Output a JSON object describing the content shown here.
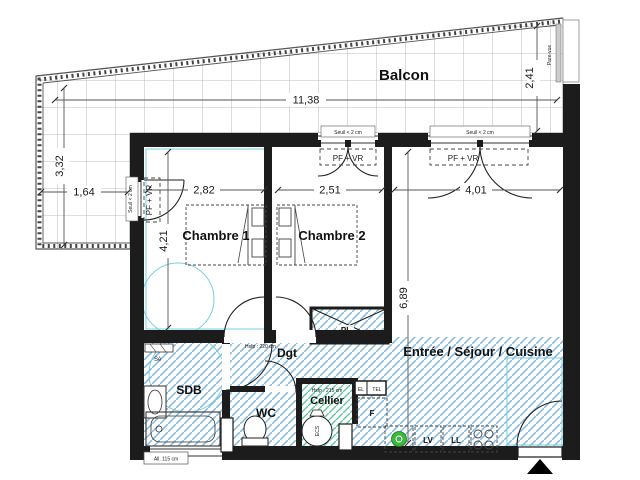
{
  "rooms": {
    "balcon": "Balcon",
    "chambre1": "Chambre 1",
    "chambre2": "Chambre 2",
    "sejour": "Entrée / Séjour / Cuisine",
    "sdb": "SDB",
    "wc": "WC",
    "dgt": "Dgt",
    "cellier": "Cellier",
    "placard": "PL"
  },
  "dimensions": {
    "balcon_length": "11,38",
    "balcon_right_depth": "2,41",
    "balcon_left_length": "3,32",
    "balcon_left_depth": "1,64",
    "chambre1_width": "2,82",
    "chambre2_width": "2,51",
    "sejour_width": "4,01",
    "chambre1_depth": "4,21",
    "sejour_depth": "6,89"
  },
  "annotations": {
    "pf_vr": "PF + VR",
    "seuil": "Seuil < 2 cm",
    "pare_vue": "Pare-vue",
    "allege": "All. 115 cm",
    "hsfp_dgt": "Hsfp : 220 cm",
    "hsfp_cellier": "Hsfp : 215 cm",
    "towel_dryer": "Sè",
    "electrical": "EL",
    "telecom": "TEL",
    "fridge": "F",
    "dishwasher": "LV",
    "washer": "LL",
    "water_heater": "ECS"
  },
  "colors": {
    "wall": "#1c1c1c",
    "hatch_blue": "#8bbdde",
    "hatch_green": "#5fc9a0",
    "accessibility_cyan": "#74cfe3",
    "sink_green": "#3cb83c"
  }
}
